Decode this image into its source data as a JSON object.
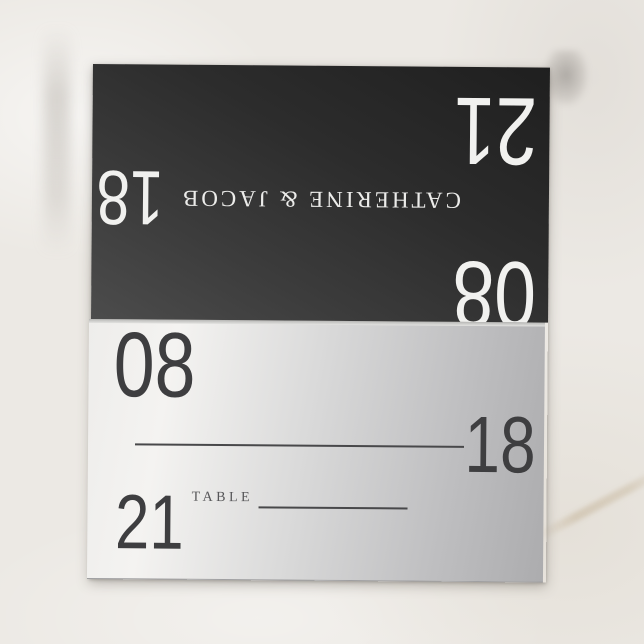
{
  "card": {
    "back": {
      "couple_names": "CATHERINE & JACOB",
      "number_top_right": "21",
      "number_left": "18",
      "number_fold": "08"
    },
    "front": {
      "number_top_left": "08",
      "number_line_right": "18",
      "number_bottom_left": "21",
      "table_label": "TABLE"
    },
    "colors": {
      "back_panel_dark": "#1f1f1f",
      "back_panel_light": "#4c4c4c",
      "back_text": "#f1f1ef",
      "front_silver_light": "#f4f3f1",
      "front_silver_dark": "#acacae",
      "front_text": "#3e3e40",
      "background_marble": "#ece9e4"
    }
  }
}
